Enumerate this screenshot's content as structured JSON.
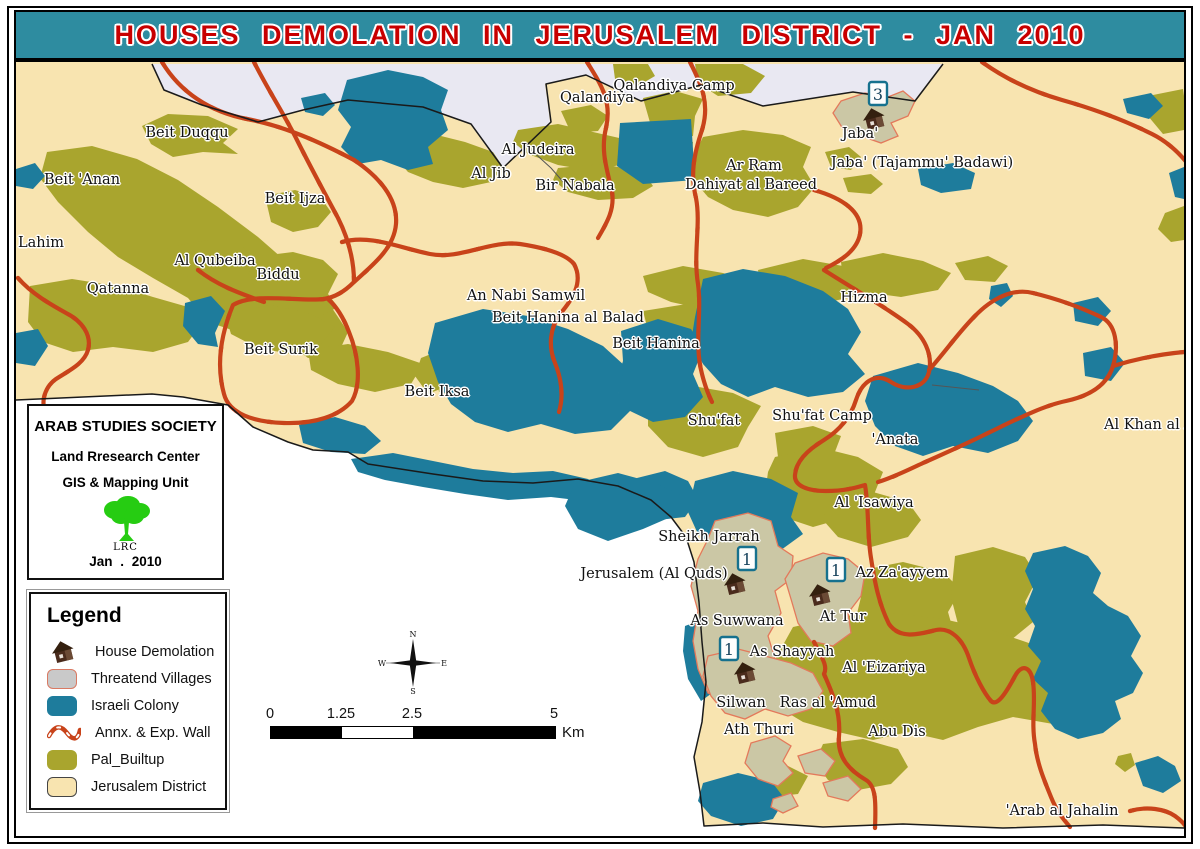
{
  "title": "HOUSES DEMOLATION IN JERUSALEM DISTRICT - JAN 2010",
  "credits": {
    "org": "ARAB STUDIES SOCIETY",
    "center": "Land Rresearch Center",
    "unit": "GIS & Mapping Unit",
    "logo": "LRC",
    "date": "Jan .  2010"
  },
  "legend": {
    "title": "Legend",
    "items": [
      {
        "label": "House Demolation",
        "swatch": "house"
      },
      {
        "label": "Threatend Villages",
        "swatch": "rect",
        "fill": "#C9C9C9",
        "stroke": "#D97A63"
      },
      {
        "label": "Israeli Colony",
        "swatch": "rect",
        "fill": "#1E7C9C",
        "stroke": "#1E7C9C"
      },
      {
        "label": "Annx. & Exp. Wall",
        "swatch": "wall"
      },
      {
        "label": "Pal_Builtup",
        "swatch": "rect",
        "fill": "#A9A52E",
        "stroke": "#A9A52E"
      },
      {
        "label": "Jerusalem District",
        "swatch": "rect",
        "fill": "#F8E4B0",
        "stroke": "#444444"
      }
    ]
  },
  "scale_bar": {
    "ticks": [
      "0",
      "1.25",
      "2.5",
      "5"
    ],
    "unit": "Km"
  },
  "compass": {
    "n": "N",
    "s": "S",
    "e": "E",
    "w": "W"
  },
  "colors": {
    "title_bg": "#2E8CA0",
    "title_text": "#C80000",
    "district_fill": "#F8E4B0",
    "pal_builtup": "#A9A52E",
    "israeli_colony": "#1E7C9C",
    "wall": "#C8431A",
    "threatened_fill": "#CBC7A5",
    "threatened_outline": "#E3795B",
    "outside_top": "#E9E8F2"
  },
  "map": {
    "markers": [
      {
        "count": "3"
      },
      {
        "count": "1"
      },
      {
        "count": "1"
      },
      {
        "count": "1"
      }
    ],
    "labels": [
      {
        "text": "Qalandiya",
        "x": 595,
        "y": 96
      },
      {
        "text": "Qalandiya Camp",
        "x": 672,
        "y": 84
      },
      {
        "text": "Beit Duqqu",
        "x": 185,
        "y": 131
      },
      {
        "text": "Al Judeira",
        "x": 536,
        "y": 148
      },
      {
        "text": "Al Jib",
        "x": 489,
        "y": 172
      },
      {
        "text": "Bir Nabala",
        "x": 573,
        "y": 184
      },
      {
        "text": "Ar Ram",
        "x": 752,
        "y": 164
      },
      {
        "text": "Dahiyat al Bareed",
        "x": 749,
        "y": 183
      },
      {
        "text": "Jaba'",
        "x": 858,
        "y": 132
      },
      {
        "text": "Jaba' (Tajammu' Badawi)",
        "x": 920,
        "y": 161
      },
      {
        "text": "Beit 'Anan",
        "x": 80,
        "y": 178
      },
      {
        "text": "Beit Ijza",
        "x": 293,
        "y": 197
      },
      {
        "text": "Lahim",
        "x": 16,
        "y": 241,
        "align": "left"
      },
      {
        "text": "Al Qubeiba",
        "x": 213,
        "y": 259
      },
      {
        "text": "Biddu",
        "x": 276,
        "y": 273
      },
      {
        "text": "Qatanna",
        "x": 116,
        "y": 287
      },
      {
        "text": "An Nabi Samwil",
        "x": 524,
        "y": 294
      },
      {
        "text": "Beit Hanina al Balad",
        "x": 566,
        "y": 316
      },
      {
        "text": "Beit Hanina",
        "x": 654,
        "y": 342
      },
      {
        "text": "Hizma",
        "x": 862,
        "y": 296
      },
      {
        "text": "Beit Surik",
        "x": 279,
        "y": 348
      },
      {
        "text": "Beit Iksa",
        "x": 435,
        "y": 390
      },
      {
        "text": "Shu'fat",
        "x": 712,
        "y": 419
      },
      {
        "text": "Shu'fat Camp",
        "x": 820,
        "y": 414
      },
      {
        "text": "'Anata",
        "x": 893,
        "y": 438
      },
      {
        "text": "Al Khan al A",
        "x": 1102,
        "y": 423,
        "align": "left"
      },
      {
        "text": "Al 'Isawiya",
        "x": 872,
        "y": 501
      },
      {
        "text": "Sheikh Jarrah",
        "x": 707,
        "y": 535
      },
      {
        "text": "Jerusalem (Al Quds)",
        "x": 652,
        "y": 572
      },
      {
        "text": "Az Za'ayyem",
        "x": 900,
        "y": 571
      },
      {
        "text": "As Suwwana",
        "x": 735,
        "y": 619
      },
      {
        "text": "At Tur",
        "x": 841,
        "y": 615
      },
      {
        "text": "As Shayyah",
        "x": 790,
        "y": 650
      },
      {
        "text": "Al 'Eizariya",
        "x": 882,
        "y": 666
      },
      {
        "text": "Silwan",
        "x": 739,
        "y": 701
      },
      {
        "text": "Ras al 'Amud",
        "x": 826,
        "y": 701
      },
      {
        "text": "Ath Thuri",
        "x": 757,
        "y": 728
      },
      {
        "text": "Abu Dis",
        "x": 895,
        "y": 730
      },
      {
        "text": "'Arab al Jahalin",
        "x": 1060,
        "y": 809
      }
    ]
  }
}
